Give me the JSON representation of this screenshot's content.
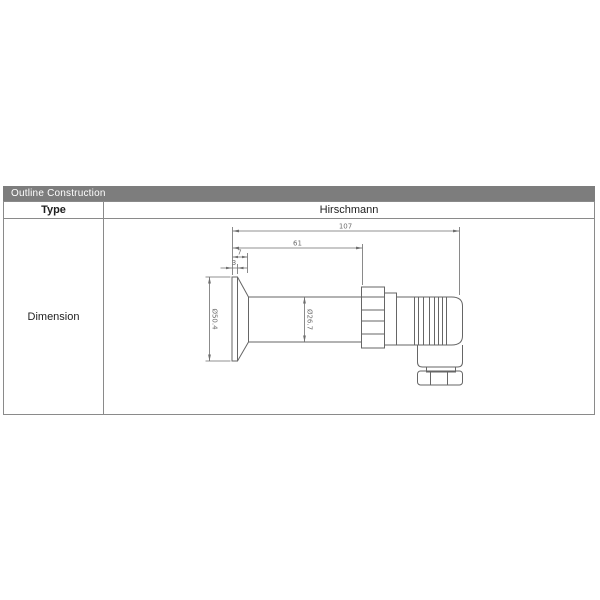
{
  "section": {
    "title": "Outline Construction",
    "bar_color": "#7d7d7d",
    "bar_text_color": "#ffffff"
  },
  "table": {
    "type_label": "Type",
    "type_value": "Hirschmann",
    "dimension_label": "Dimension"
  },
  "drawing": {
    "description": "side-view outline of pressure transmitter with Hirschmann connector",
    "line_color": "#666666",
    "dim_color": "#6e6e6e",
    "dims": {
      "overall_length": "107",
      "body_length": "61",
      "flange_depth": "7",
      "diaphragm_thickness": "3",
      "flange_diameter": "Ø50.4",
      "body_diameter": "Ø26.7"
    }
  }
}
